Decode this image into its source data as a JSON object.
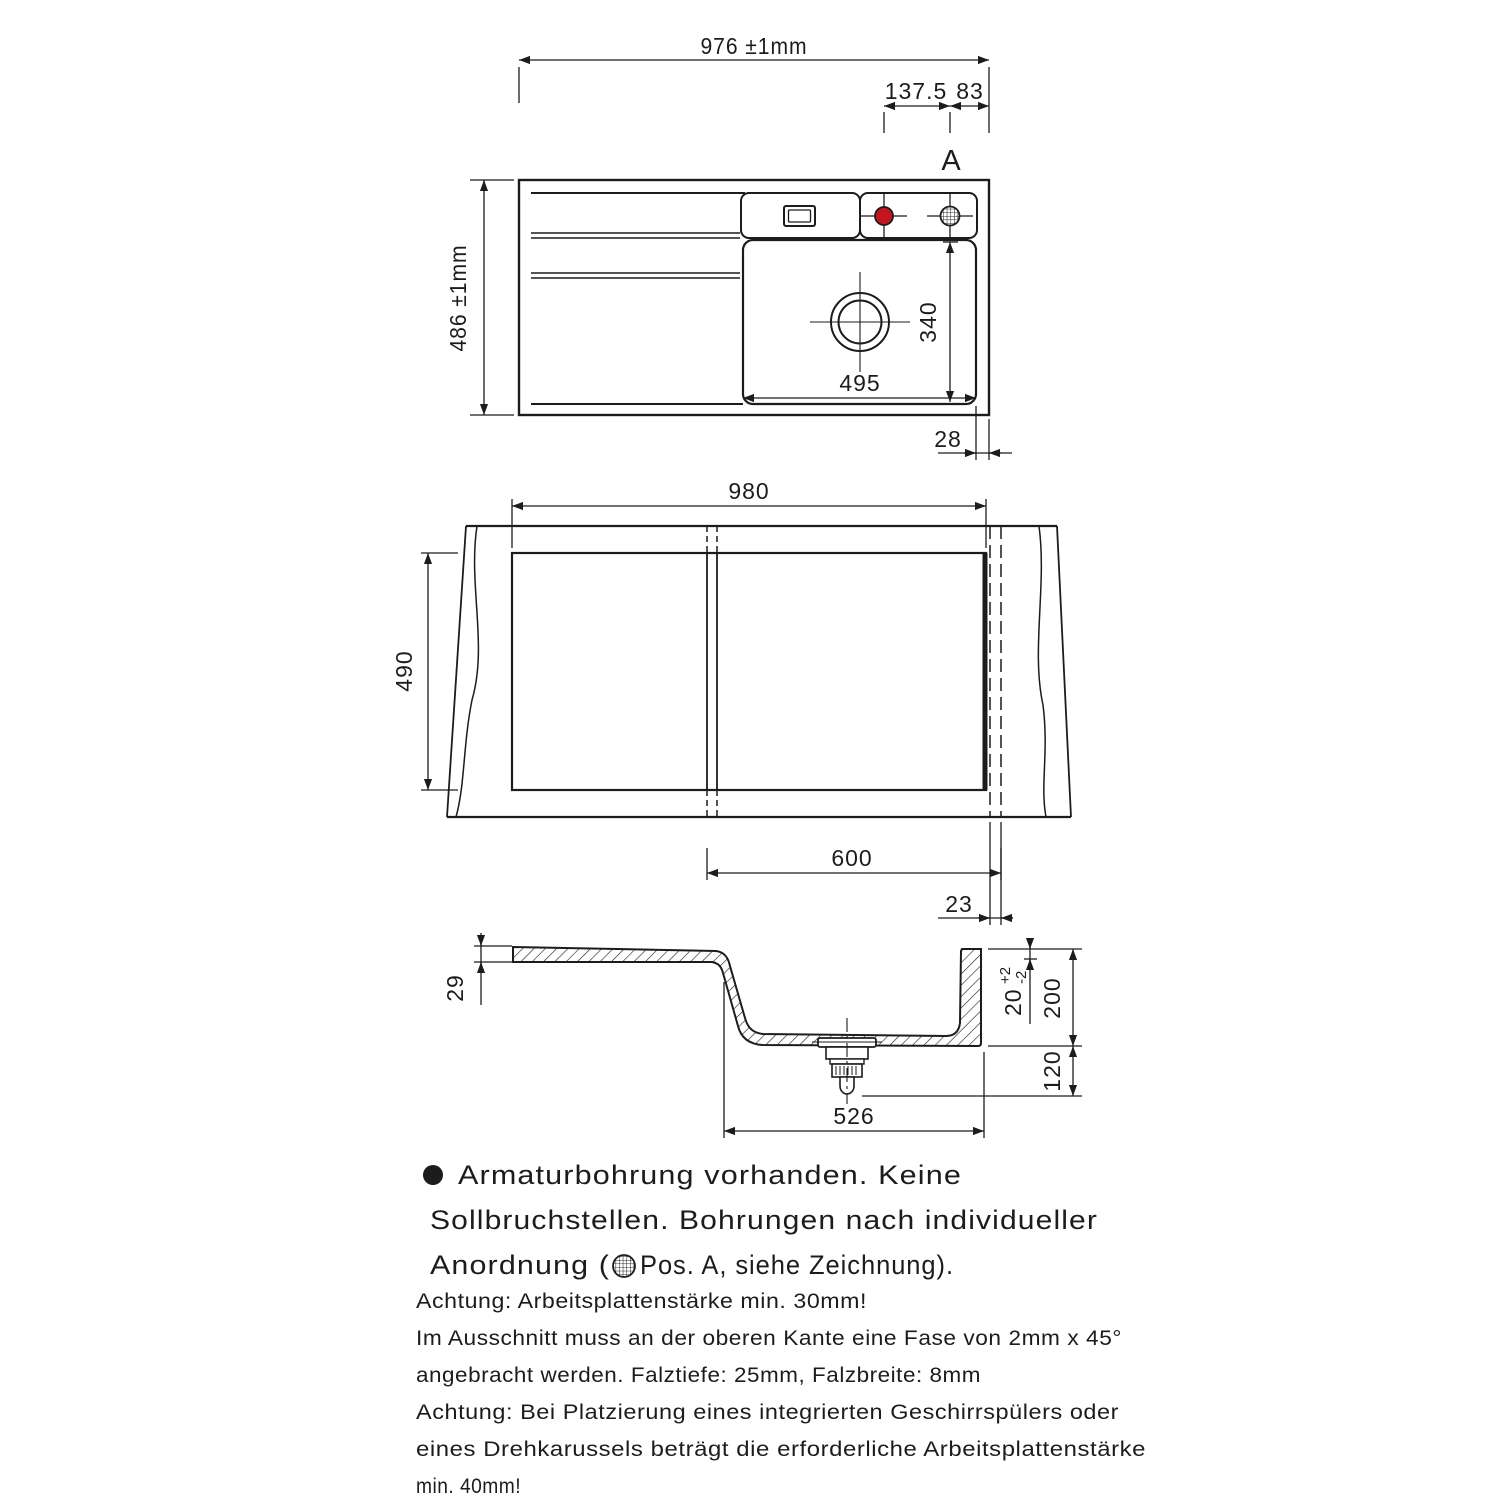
{
  "colors": {
    "ink": "#1c1c1c",
    "hole_red": "#c41420"
  },
  "top_view": {
    "width_label": "976 ±1mm",
    "height_label": "486 ±1mm",
    "hole_pitch": "137.5",
    "hole_edge_dist": "83",
    "hole_position": "A",
    "bowl_width": "495",
    "bowl_depth": "340",
    "rim_offset": "28"
  },
  "cutout_view": {
    "cutout_width": "980",
    "cutout_height": "490",
    "cabinet_width": "600",
    "edge_gap": "23"
  },
  "section_view": {
    "front_edge_thickness": "29",
    "rim_height": "20",
    "rim_tol_plus": "+2",
    "rim_tol_minus": "-2",
    "bowl_depth": "200",
    "drain_clearance": "120",
    "bowl_bottom_width": "526"
  },
  "notes": {
    "bullet_line1": "Armaturbohrung vorhanden. Keine",
    "bullet_line2": "Sollbruchstellen. Bohrungen nach individueller",
    "bullet_line3_prefix": "Anordnung (",
    "bullet_line3_suffix": "Pos. A, siehe Zeichnung).",
    "attention": [
      "Achtung: Arbeitsplattenstärke min. 30mm!",
      "Im Ausschnitt muss an der oberen Kante eine Fase von 2mm x 45°",
      "angebracht werden. Falztiefe: 25mm, Falzbreite: 8mm",
      "Achtung: Bei Platzierung eines integrierten Geschirrspülers oder",
      "eines Drehkarussels beträgt die erforderliche Arbeitsplattenstärke",
      "min. 40mm!"
    ]
  }
}
